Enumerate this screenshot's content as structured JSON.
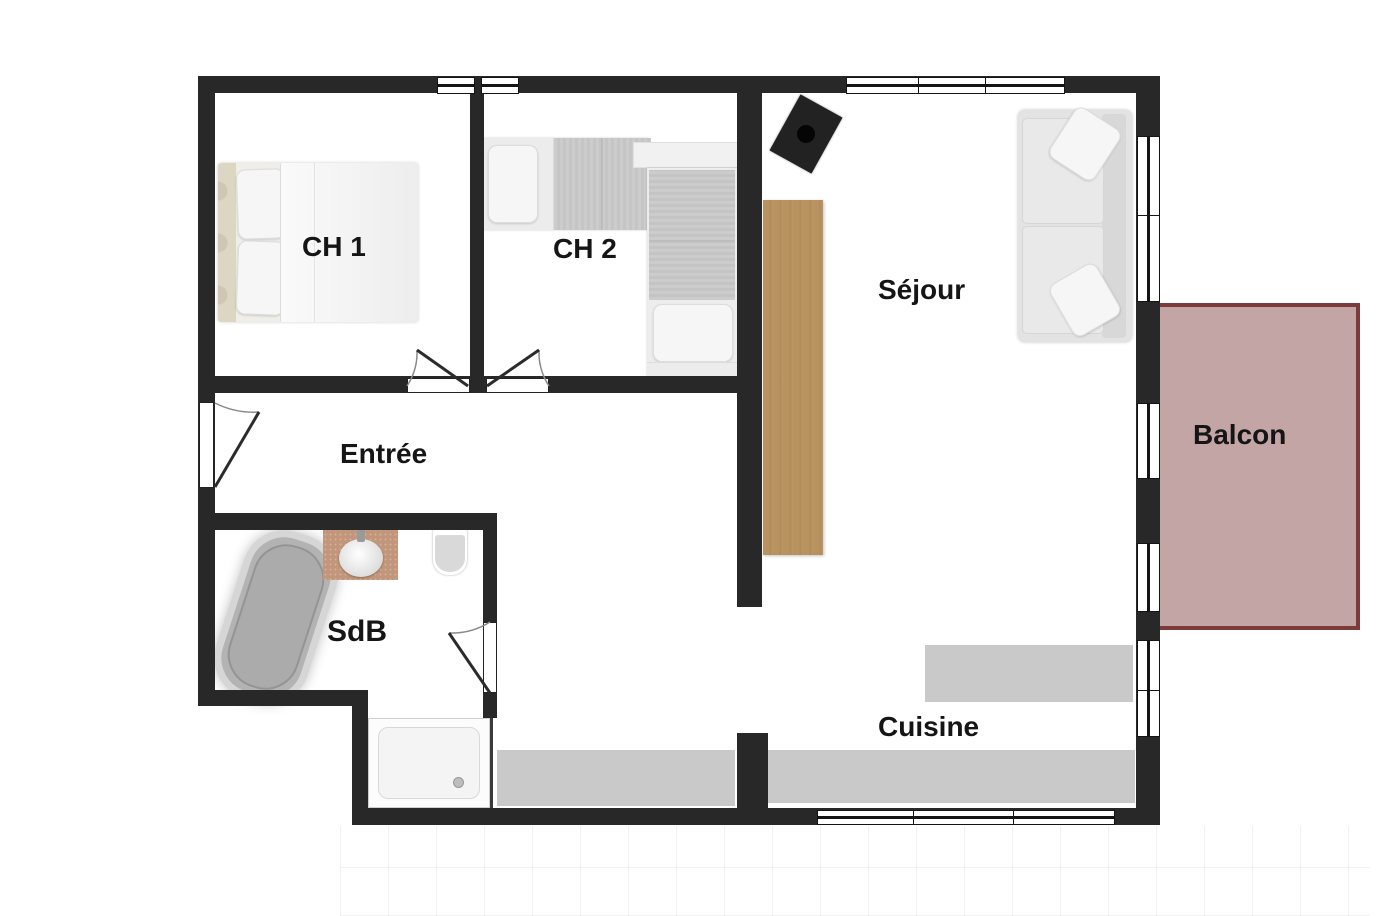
{
  "plan": {
    "title": "apartment-floor-plan",
    "rooms": {
      "ch1": {
        "label": "CH 1"
      },
      "ch2": {
        "label": "CH 2"
      },
      "sejour": {
        "label": "Séjour"
      },
      "entree": {
        "label": "Entrée"
      },
      "sdb": {
        "label": "SdB"
      },
      "cuisine": {
        "label": "Cuisine"
      },
      "balcon": {
        "label": "Balcon"
      }
    },
    "colors": {
      "wall": "#282828",
      "balcony_fill": "#c4a5a5",
      "balcony_border": "#7c3a3a",
      "wood": "#b8925f",
      "counter": "#c9c9c9",
      "floor": "#ffffff"
    }
  }
}
